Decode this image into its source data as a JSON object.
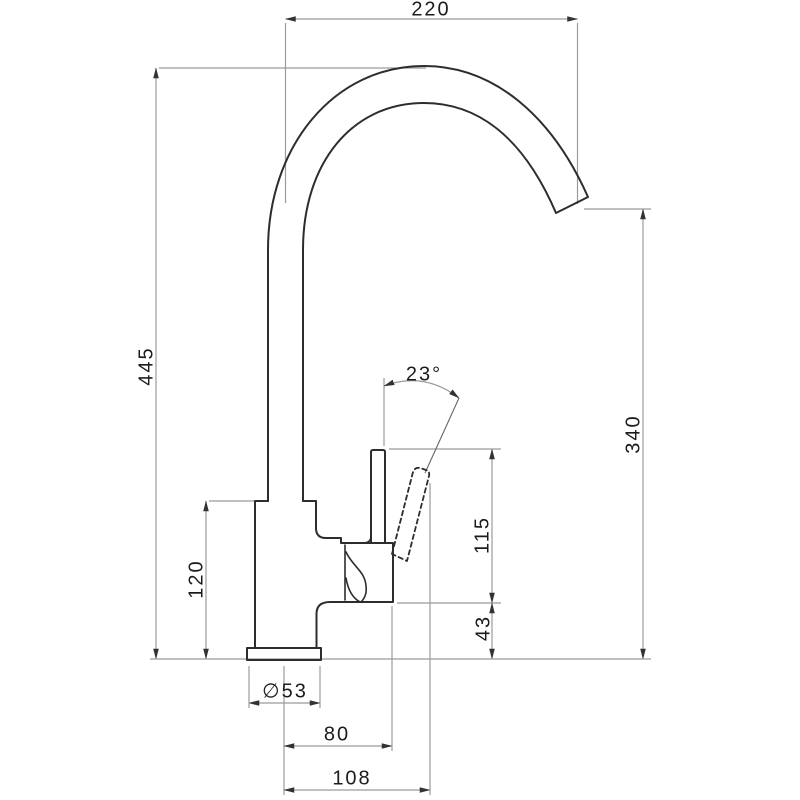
{
  "title": "Kitchen sink mixer tap dimension drawing (side elevation)",
  "units": "mm",
  "colors": {
    "object_line": "#2d2d2d",
    "dimension_line": "#9b9b9b",
    "arrow": "#333333",
    "text": "#1c1c1c",
    "background": "#ffffff"
  },
  "labels": {
    "spout_reach": "220",
    "overall_height": "445",
    "outlet_height": "340",
    "handle_angle": "23°",
    "handle_lever_height": "115",
    "body_step_height": "43",
    "body_height": "120",
    "base_diameter": "∅53",
    "cartridge_offset": "80",
    "handle_tip_offset": "108"
  }
}
